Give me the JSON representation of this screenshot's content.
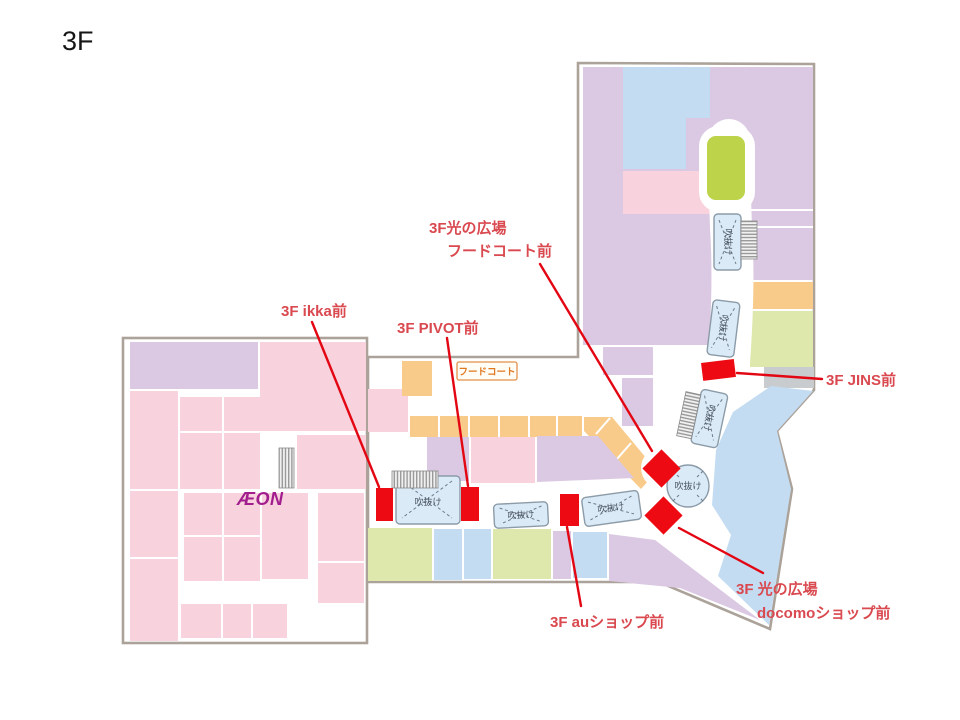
{
  "title": "3F",
  "legend_labels": {
    "atrium": "吹抜け",
    "foodcourt_badge": "フードコート",
    "aeon_logo": "ÆON"
  },
  "callouts": {
    "hikari_foodcourt_line1": "3F光の広場",
    "hikari_foodcourt_line2": "フードコート前",
    "ikka": "3F ikka前",
    "pivot": "3F PIVOT前",
    "jins": "3F JINS前",
    "au": "3F auショップ前",
    "docomo_line1": "3F 光の広場",
    "docomo_line2": "docomoショップ前"
  },
  "colors": {
    "shop-pink": "#F8D2DC",
    "shop-lavender": "#DBC8E2",
    "shop-orange": "#F9CB8B",
    "shop-lime": "#BCD34A",
    "shop-green": "#DEE7AC",
    "shop-blue": "#C3DCF2",
    "atrium-fill": "#DAEAF7",
    "atrium-border": "#8C9BA8",
    "marker-red": "#EE0A12",
    "callout-red": "#D9494F",
    "line-red": "#E30613",
    "outline-gray": "#ABA29A",
    "gray-block": "#C9CCCE",
    "badge-orange": "#E07820"
  }
}
